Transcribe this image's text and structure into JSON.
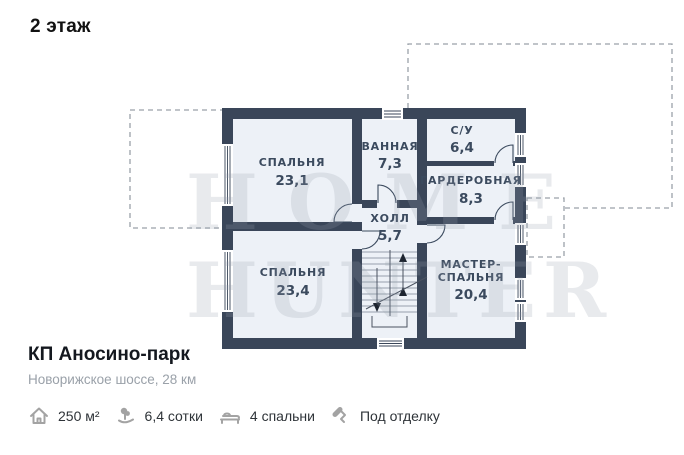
{
  "page": {
    "title": "2 этаж"
  },
  "floor_plan": {
    "rooms": [
      {
        "label": "СПАЛЬНЯ",
        "area": "23,1"
      },
      {
        "label": "ВАННАЯ",
        "area": "7,3"
      },
      {
        "label": "С/У",
        "area": "6,4"
      },
      {
        "label": "ГАРДЕРОБНАЯ",
        "area": "8,3"
      },
      {
        "label": "ХОЛЛ",
        "area": "5,7"
      },
      {
        "label": "СПАЛЬНЯ",
        "area": "23,4"
      },
      {
        "label": "МАСТЕР-",
        "label2": "СПАЛЬНЯ",
        "area": "20,4"
      }
    ],
    "watermark": {
      "line1": "HOME",
      "line2": "HUNTER"
    }
  },
  "listing": {
    "name": "КП Аносино-парк",
    "location": "Новорижское шоссе, 28 км",
    "features": [
      {
        "icon": "house-icon",
        "label": "250 м²"
      },
      {
        "icon": "land-area-icon",
        "label": "6,4 сотки"
      },
      {
        "icon": "bed-icon",
        "label": "4 спальни"
      },
      {
        "icon": "paint-roller-icon",
        "label": "Под отделку"
      }
    ]
  },
  "colors": {
    "wall": "#3a4659",
    "floor": "#edf1f7",
    "room-label": "#3b4a5e",
    "dashed": "#9aa1a9",
    "title": "#111111",
    "listing-name": "#14181f",
    "location": "#9aa1a9",
    "feature-text": "#2e3338",
    "feature-icon": "#a3a3a3",
    "watermark": "rgba(150,160,175,0.22)"
  }
}
